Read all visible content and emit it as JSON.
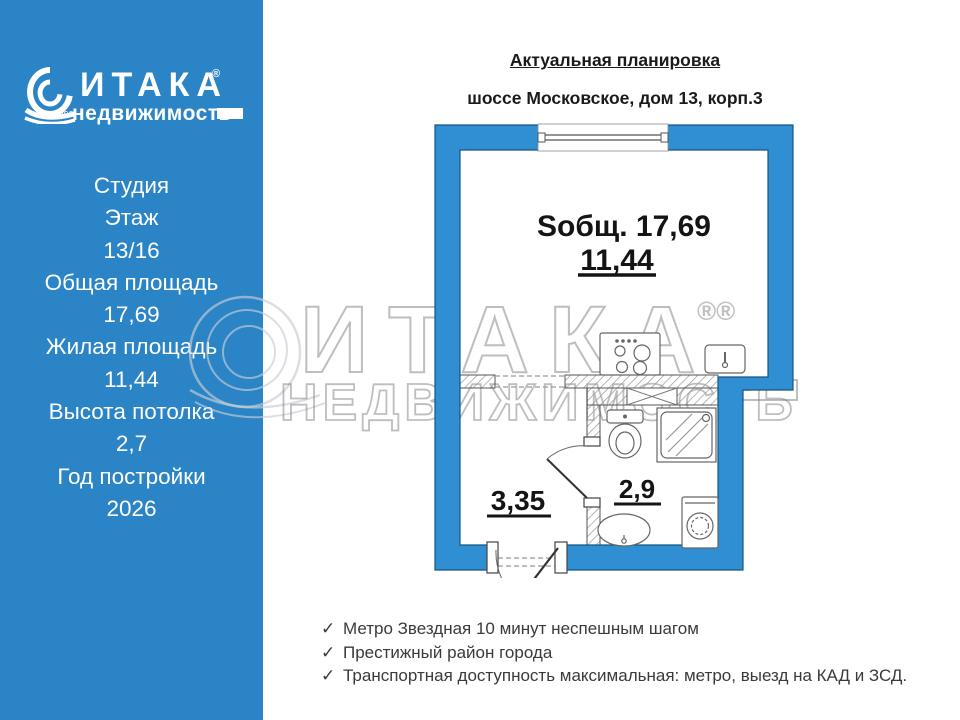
{
  "sidebar": {
    "logo": {
      "brand": "ИТАКА",
      "reg": "®",
      "sub": "недвижимость",
      "year": "1993"
    },
    "stats": [
      "Студия",
      "Этаж",
      "13/16",
      "Общая площадь",
      "17,69",
      "Жилая площадь",
      "11,44",
      "Высота потолка",
      "2,7",
      "Год постройки",
      "2026"
    ]
  },
  "header": {
    "title": "Актуальная планировка",
    "subtitle": "шоссе Московское, дом 13, корп.3"
  },
  "plan": {
    "labels": {
      "total_area": "Sобщ. 17,69",
      "living_area": "11,44",
      "hall_area": "3,35",
      "bath_area": "2,9"
    }
  },
  "watermark": {
    "brand": "ИТАКА",
    "reg": "®®",
    "sub": "НЕДВИЖИМОСТЬ"
  },
  "features": {
    "check_glyph": "✓",
    "items": [
      "Метро Звездная 10  минут неспешным шагом",
      "Престижный район города",
      "Транспортная доступность максимальная: метро, выезд на КАД и ЗСД."
    ]
  },
  "colors": {
    "sidebar_blue": "#2a84c5",
    "wall_blue": "#2f8fd2",
    "text_dark": "#1a1a1a",
    "watermark_gray": "#8a8a8a"
  }
}
